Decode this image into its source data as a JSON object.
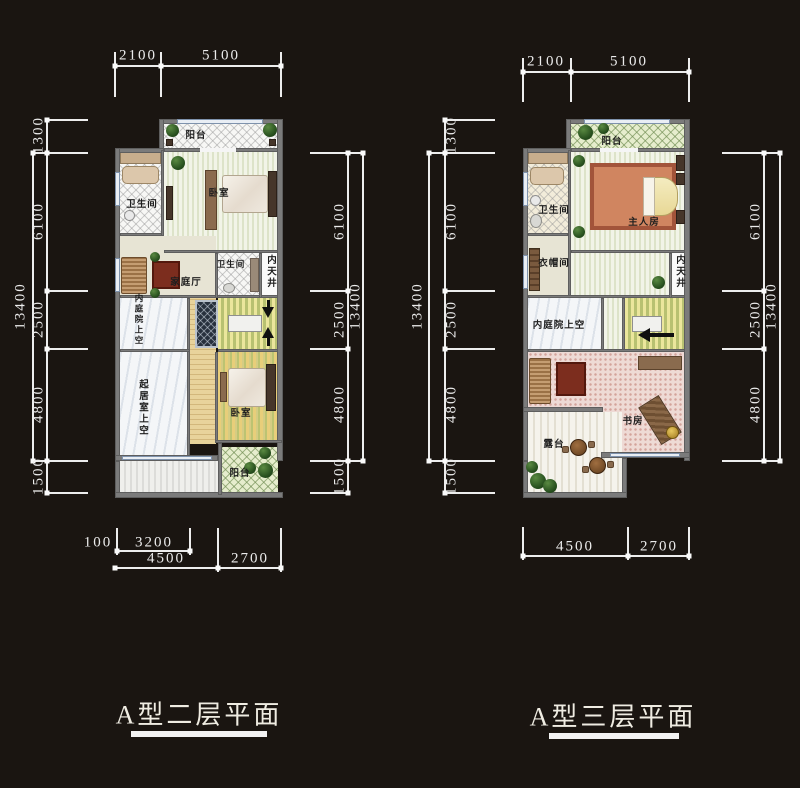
{
  "plans": [
    {
      "caption": "A型二层平面",
      "dims": {
        "top": [
          "2100",
          "5100"
        ],
        "left": [
          "1300",
          "6100",
          "2500",
          "4800",
          "1500"
        ],
        "left_total": "13400",
        "right": [
          "6100",
          "2500",
          "4800",
          "1500"
        ],
        "right_total": "13400",
        "bottom_upper": [
          "100",
          "3200"
        ],
        "bottom": [
          "4500",
          "2700"
        ]
      },
      "rooms": {
        "balcony_top": "阳台",
        "bedroom1": "卧室",
        "bath1": "卫生间",
        "family_hall": "家庭厅",
        "bath2": "卫生间",
        "lightwell": "内天井",
        "courtyard_void": "内庭院上空",
        "living_void": "起居室上空",
        "bedroom2": "卧室",
        "balcony_bottom": "阳台"
      }
    },
    {
      "caption": "A型三层平面",
      "dims": {
        "top": [
          "2100",
          "5100"
        ],
        "left": [
          "1300",
          "6100",
          "2500",
          "4800",
          "1500"
        ],
        "left_total": "13400",
        "right": [
          "6100",
          "2500",
          "4800"
        ],
        "right_total": "13400",
        "bottom": [
          "4500",
          "2700"
        ]
      },
      "rooms": {
        "balcony_top": "阳台",
        "bath": "卫生间",
        "master": "主人房",
        "cloakroom": "衣帽间",
        "lightwell": "内天井",
        "courtyard_void": "内庭院上空",
        "study": "书房",
        "terrace": "露台"
      }
    }
  ]
}
